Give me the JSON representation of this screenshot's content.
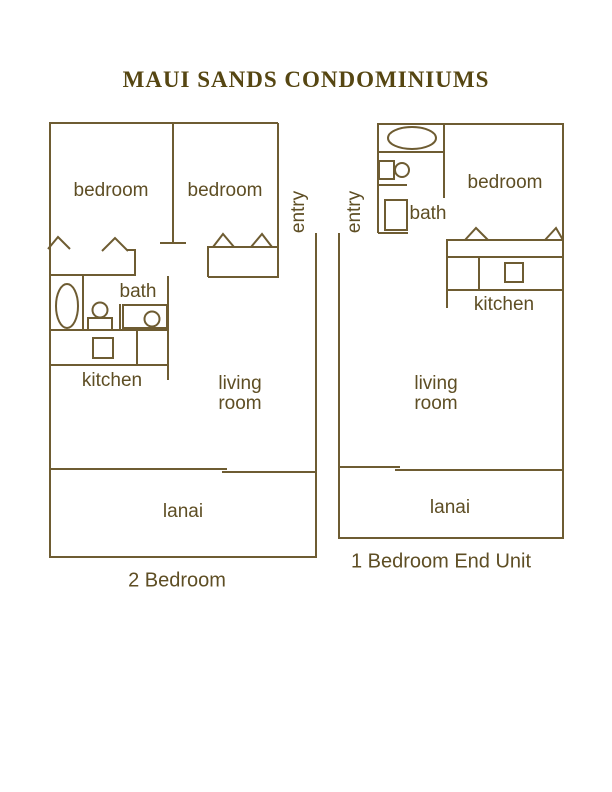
{
  "title": "MAUI SANDS CONDOMINIUMS",
  "colors": {
    "line": "#6e5c32",
    "label_text": "#5e4e24",
    "title_text": "#564612"
  },
  "left_unit": {
    "caption": "2 Bedroom",
    "labels": {
      "bedroom_left": "bedroom",
      "bedroom_right": "bedroom",
      "entry": "entry",
      "bath": "bath",
      "kitchen": "kitchen",
      "living_room": "living room",
      "lanai": "lanai"
    }
  },
  "right_unit": {
    "caption": "1 Bedroom End Unit",
    "labels": {
      "entry": "entry",
      "bath": "bath",
      "bedroom": "bedroom",
      "kitchen": "kitchen",
      "living_room": "living room",
      "lanai": "lanai"
    }
  }
}
